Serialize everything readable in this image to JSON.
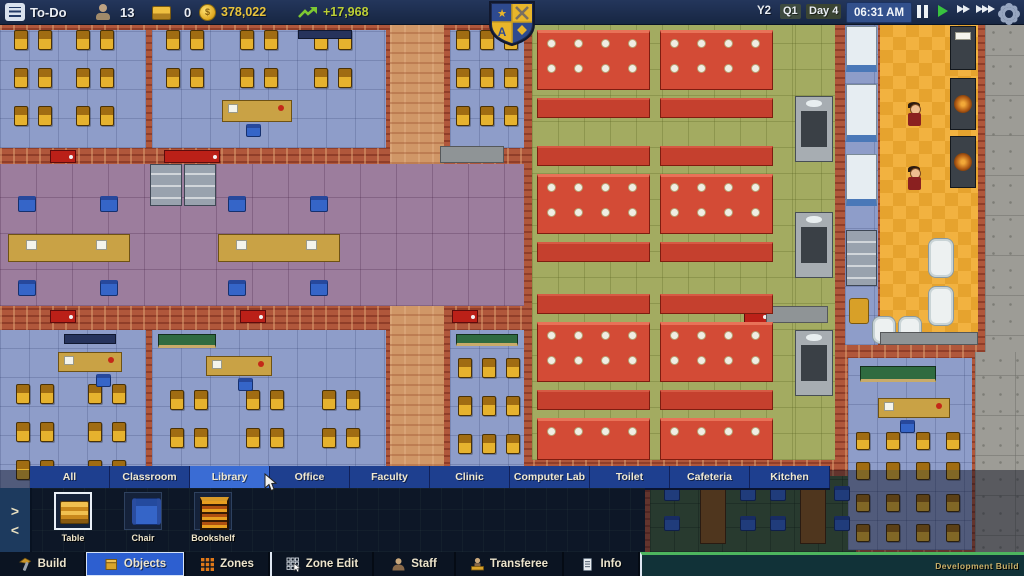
{
  "top_bar": {
    "menu_label": "To-Do",
    "students_count": "13",
    "applicants_count": "0",
    "funds": "378,022",
    "income": "+17,968",
    "year": "Y2",
    "quarter": "Q1",
    "day": "Day 4",
    "clock": "06:31 AM"
  },
  "category_tabs": {
    "selected": "Library",
    "items": [
      "All",
      "Classroom",
      "Library",
      "Office",
      "Faculty",
      "Clinic",
      "Computer Lab",
      "Toilet",
      "Cafeteria",
      "Kitchen"
    ]
  },
  "object_palette": {
    "selected": "Table",
    "items": [
      {
        "label": "Table",
        "icon": "table-icon"
      },
      {
        "label": "Chair",
        "icon": "chair-icon"
      },
      {
        "label": "Bookshelf",
        "icon": "bookshelf-icon"
      }
    ],
    "nav_next": ">",
    "nav_prev": "<"
  },
  "bottom_bar": {
    "selected": "Objects",
    "items": [
      {
        "label": "Build",
        "icon": "hammer-icon"
      },
      {
        "label": "Objects",
        "icon": "objects-box-icon"
      },
      {
        "label": "Zones",
        "icon": "zones-grid-icon"
      },
      {
        "label": "Zone Edit",
        "icon": "zone-edit-icon"
      },
      {
        "label": "Staff",
        "icon": "staff-icon"
      },
      {
        "label": "Transferee",
        "icon": "transferee-icon"
      },
      {
        "label": "Info",
        "icon": "info-icon"
      }
    ],
    "dev_label": "Development Build"
  },
  "colors": {
    "topbar_bg": "#1b2947",
    "gold_text": "#e9c43c",
    "income_green": "#bccf35",
    "tab_blue": "#1e3f8f",
    "tab_selected": "#3a6cd4",
    "panel_bg": "#0d1727",
    "accent_blue": "#2d5fd0",
    "dev_strip_green": "#4db55e",
    "floor_classroom": "#8e9dc9",
    "floor_hall": "#9c7d9d",
    "floor_cafeteria": "#a3ab61",
    "floor_kitchen": "#f0ad3a",
    "floor_corridor": "#d09767",
    "wall_brick": "#b0573b",
    "door_red": "#bb2018",
    "desk_gold": "#e6b22e",
    "table_red": "#d34b36",
    "chair_blue": "#3565c8",
    "concrete": "#9d9c96"
  }
}
